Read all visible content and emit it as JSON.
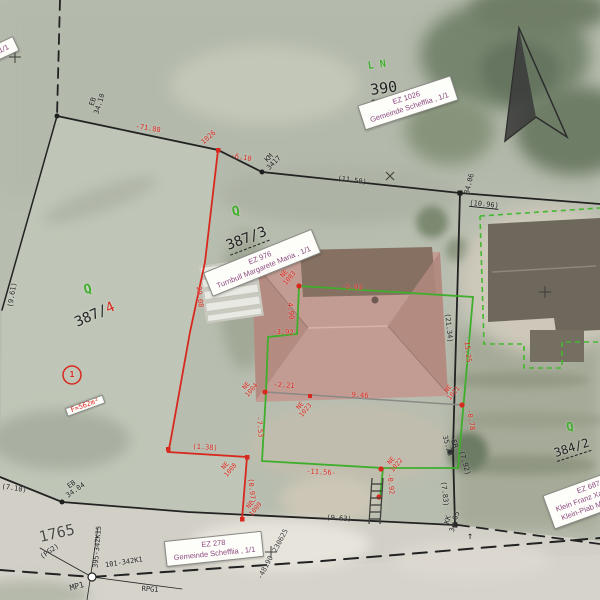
{
  "map_colors": {
    "measurement_red": "#d8291f",
    "vector_green": "#3fae2c",
    "owner_label_text": "#8d4a7f",
    "line_black": "#222222",
    "basemap_green": "#b7bdaf",
    "road_gray": "#d6d3cb",
    "roof_pink": "#c29b92"
  },
  "owner_labels": [
    {
      "n": "owner-label-390",
      "lines": [
        "EZ 1026",
        "Gemeinde Schefflia , 1/1"
      ],
      "x": 408,
      "y": 103,
      "rot": -18
    },
    {
      "n": "owner-label-387-3",
      "lines": [
        "EZ 976",
        "Turnbull Margarete Maria , 1/1"
      ],
      "x": 262,
      "y": 263,
      "rot": -22
    },
    {
      "n": "owner-label-road",
      "lines": [
        "EZ 278",
        "Gemeinde Schefflia , 1/1"
      ],
      "x": 214,
      "y": 549,
      "rot": -6
    },
    {
      "n": "owner-label-384-2",
      "lines": [
        "EZ 687",
        "Klein Franz Xaver , 1/2",
        "Klein-Piab Maria , 1/2"
      ],
      "x": 592,
      "y": 497,
      "rot": -20
    },
    {
      "n": "owner-label-partial",
      "lines": [
        ", 1/1"
      ],
      "x": 2,
      "y": 50,
      "rot": -25
    }
  ],
  "annotations": [
    {
      "n": "parcel-label-390",
      "t": "390",
      "x": 384,
      "y": 90,
      "rot": -8,
      "fs": 15,
      "du": 1
    },
    {
      "n": "landuse-code-ln",
      "t": "L N",
      "x": 377,
      "y": 66,
      "rot": -8,
      "fs": 10,
      "c": "#3fae2c",
      "b": 1
    },
    {
      "n": "parcel-label-387-3",
      "t": "387/3",
      "x": 247,
      "y": 240,
      "rot": -21,
      "fs": 14,
      "du": 1
    },
    {
      "n": "area-label-387-3",
      "t": "F=725m²",
      "x": 253,
      "y": 261,
      "rot": -17,
      "fs": 7,
      "chip": 1
    },
    {
      "n": "landuse-q-387-3",
      "t": "Q",
      "x": 236,
      "y": 212,
      "rot": -12,
      "fs": 13,
      "c": "#3fae2c",
      "b": 1
    },
    {
      "n": "parcel-label-387-4",
      "parts": [
        {
          "t": "387/"
        },
        {
          "t": "4",
          "c": "#d8291f"
        }
      ],
      "x": 95,
      "y": 315,
      "rot": -24,
      "fs": 14
    },
    {
      "n": "landuse-q-387-4",
      "t": "Q",
      "x": 88,
      "y": 290,
      "rot": -15,
      "fs": 13,
      "c": "#3fae2c",
      "b": 1
    },
    {
      "n": "note-circle-1",
      "t": "1",
      "x": 72,
      "y": 375,
      "rot": 0,
      "fs": 8,
      "c": "#d8291f",
      "b": 1
    },
    {
      "n": "area-label-387-4",
      "t": "F=562m²",
      "x": 85,
      "y": 406,
      "rot": -20,
      "fs": 7,
      "c": "#d8291f",
      "chip": 1
    },
    {
      "n": "parcel-label-384-2",
      "t": "384/2",
      "x": 572,
      "y": 449,
      "rot": -18,
      "fs": 12,
      "du": 1
    },
    {
      "n": "landuse-q-384-2",
      "t": "Q",
      "x": 570,
      "y": 427,
      "rot": -12,
      "fs": 12,
      "c": "#3fae2c",
      "b": 1
    },
    {
      "n": "parcel-label-1765",
      "t": "1765",
      "x": 57,
      "y": 534,
      "rot": -13,
      "fs": 15,
      "c": "#4b4b46"
    },
    {
      "n": "dim-eb-34-10",
      "t": "EB\n34.10",
      "x": 97,
      "y": 103,
      "rot": -72,
      "fs": 7
    },
    {
      "n": "dim-9-61",
      "t": "(9.61)",
      "x": 13,
      "y": 295,
      "rot": -80,
      "fs": 7
    },
    {
      "n": "dim-7-10",
      "t": "(7.10)",
      "x": 14,
      "y": 489,
      "rot": 9,
      "fs": 7
    },
    {
      "n": "dim-eb-34-04",
      "t": "EB\n34.04",
      "x": 74,
      "y": 488,
      "rot": -35,
      "fs": 7
    },
    {
      "n": "dim-71-88",
      "t": "-71.88",
      "x": 148,
      "y": 129,
      "rot": 9,
      "fs": 7,
      "c": "#d8291f"
    },
    {
      "n": "pt-label-1026",
      "t": "1026",
      "x": 209,
      "y": 138,
      "rot": -42,
      "fs": 7,
      "c": "#d8291f"
    },
    {
      "n": "dim-6-10",
      "t": "-6.10",
      "x": 241,
      "y": 158,
      "rot": 10,
      "fs": 7,
      "c": "#d8291f"
    },
    {
      "n": "dim-km-3417",
      "t": "KM\n3417",
      "x": 272,
      "y": 161,
      "rot": -45,
      "fs": 7
    },
    {
      "n": "dim-11-50",
      "t": "(11.50)",
      "x": 352,
      "y": 181,
      "rot": 7,
      "fs": 7
    },
    {
      "n": "dim-34-06",
      "t": "34.06",
      "x": 470,
      "y": 184,
      "rot": -76,
      "fs": 7
    },
    {
      "n": "dim-10-96",
      "t": "(10.96)",
      "x": 484,
      "y": 205,
      "rot": 6,
      "fs": 7,
      "u": 1
    },
    {
      "n": "dim-29-08",
      "t": "29.08",
      "x": 199,
      "y": 297,
      "rot": 84,
      "fs": 7,
      "c": "#d8291f"
    },
    {
      "n": "dim-21-34",
      "t": "(21.34)",
      "x": 448,
      "y": 328,
      "rot": 84,
      "fs": 7
    },
    {
      "n": "dim-eb-35-23",
      "t": "EB\n35.23",
      "x": 450,
      "y": 445,
      "rot": 74,
      "fs": 7
    },
    {
      "n": "dim-7-92",
      "t": "(7.92)",
      "x": 464,
      "y": 463,
      "rot": 74,
      "fs": 7
    },
    {
      "n": "dim-7-83",
      "t": "(7.83)",
      "x": 444,
      "y": 494,
      "rot": 84,
      "fs": 7
    },
    {
      "n": "dim-kk-34-05",
      "t": "KK\n34.05",
      "x": 452,
      "y": 521,
      "rot": -74,
      "fs": 7
    },
    {
      "n": "corner-arrow",
      "t": "↑",
      "x": 470,
      "y": 537,
      "rot": 0,
      "fs": 10
    },
    {
      "n": "dim-9-63",
      "t": "(9.63)",
      "x": 339,
      "y": 519,
      "rot": 4,
      "fs": 7
    },
    {
      "n": "dim-1-38",
      "t": "(1.38)",
      "x": 205,
      "y": 448,
      "rot": 4,
      "fs": 7,
      "c": "#d8291f"
    },
    {
      "n": "dim-0-97",
      "t": "(0.97)",
      "x": 251,
      "y": 491,
      "rot": 84,
      "fs": 7,
      "c": "#d8291f"
    },
    {
      "n": "pt-label-1008",
      "t": "NE\n1008",
      "x": 228,
      "y": 468,
      "rot": -50,
      "fs": 6.5,
      "c": "#d8291f"
    },
    {
      "n": "pt-label-1009",
      "t": "NE\n1009",
      "x": 253,
      "y": 507,
      "rot": -50,
      "fs": 6.5,
      "c": "#d8291f"
    },
    {
      "n": "pt-label-1003",
      "t": "NE\n1003",
      "x": 287,
      "y": 276,
      "rot": -50,
      "fs": 6.5,
      "c": "#d8291f"
    },
    {
      "n": "pt-label-1004",
      "t": "NE\n1004",
      "x": 249,
      "y": 388,
      "rot": -50,
      "fs": 6.5,
      "c": "#d8291f"
    },
    {
      "n": "pt-label-1023",
      "t": "NE\n1023",
      "x": 303,
      "y": 408,
      "rot": -50,
      "fs": 6.5,
      "c": "#d8291f"
    },
    {
      "n": "pt-label-1021",
      "t": "NE\n1021",
      "x": 451,
      "y": 391,
      "rot": -50,
      "fs": 6.5,
      "c": "#d8291f"
    },
    {
      "n": "pt-label-1022",
      "t": "NE\n1022",
      "x": 394,
      "y": 463,
      "rot": -50,
      "fs": 6.5,
      "c": "#d8291f"
    },
    {
      "n": "dim-5-03",
      "t": "-5.03",
      "x": 352,
      "y": 288,
      "rot": 3,
      "fs": 7,
      "c": "#d8291f"
    },
    {
      "n": "dim-4-90",
      "t": "4.90",
      "x": 290,
      "y": 311,
      "rot": 84,
      "fs": 7,
      "c": "#d8291f"
    },
    {
      "n": "dim-3-92",
      "t": "-3.92",
      "x": 283,
      "y": 333,
      "rot": 3,
      "fs": 7,
      "c": "#d8291f"
    },
    {
      "n": "dim-7-53",
      "t": "-7.53",
      "x": 259,
      "y": 427,
      "rot": 84,
      "fs": 7,
      "c": "#d8291f"
    },
    {
      "n": "dim-2-21",
      "t": "-2.21",
      "x": 284,
      "y": 386,
      "rot": 4,
      "fs": 7,
      "c": "#d8291f"
    },
    {
      "n": "dim-9-46",
      "t": "9.46",
      "x": 360,
      "y": 396,
      "rot": 4,
      "fs": 7,
      "c": "#d8291f"
    },
    {
      "n": "dim-0-78",
      "t": "-0.78",
      "x": 470,
      "y": 420,
      "rot": 80,
      "fs": 7,
      "c": "#d8291f"
    },
    {
      "n": "dim-15-25",
      "t": "15.25",
      "x": 467,
      "y": 352,
      "rot": 84,
      "fs": 7,
      "c": "#d8291f"
    },
    {
      "n": "dim-11-56",
      "t": "-11.56-",
      "x": 321,
      "y": 473,
      "rot": 3,
      "fs": 7,
      "c": "#d8291f"
    },
    {
      "n": "dim-0-92",
      "t": "-0.92",
      "x": 390,
      "y": 484,
      "rot": 84,
      "fs": 7,
      "c": "#d8291f"
    },
    {
      "n": "coord-easting",
      "t": "230625",
      "x": 281,
      "y": 541,
      "rot": -62,
      "fs": 7,
      "c": "#3d3d3a"
    },
    {
      "n": "coord-northing",
      "t": "-48190",
      "x": 266,
      "y": 568,
      "rot": -62,
      "fs": 7,
      "c": "#3d3d3a"
    },
    {
      "n": "survey-pt-mp1",
      "t": "MP1",
      "x": 77,
      "y": 587,
      "rot": -15,
      "fs": 8
    },
    {
      "n": "survey-pt-pg2",
      "t": "(PG2)",
      "x": 50,
      "y": 552,
      "rot": -35,
      "fs": 7
    },
    {
      "n": "survey-pt-rpg1",
      "t": "RPG1",
      "x": 150,
      "y": 590,
      "rot": 4,
      "fs": 7
    },
    {
      "n": "survey-ref-101-342k1",
      "t": "101-342K1",
      "x": 124,
      "y": 563,
      "rot": -9,
      "fs": 7
    },
    {
      "n": "survey-ref-395-34zk15",
      "t": "395-34ZK15",
      "x": 98,
      "y": 547,
      "rot": -85,
      "fs": 7
    }
  ]
}
